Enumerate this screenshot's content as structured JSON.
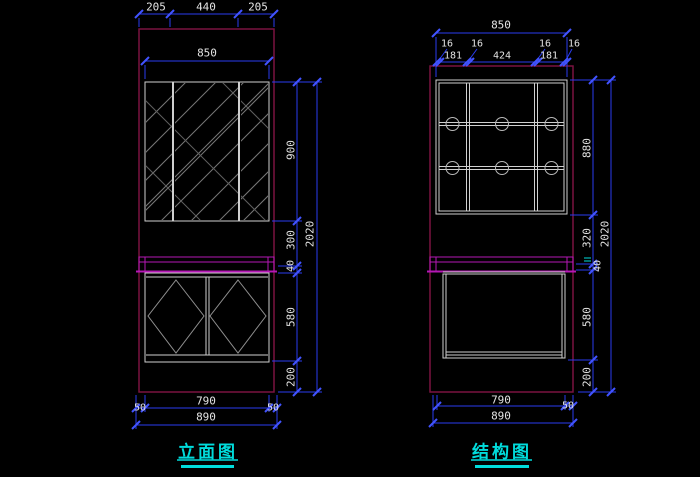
{
  "app": {
    "type": "cad-drawing-viewport",
    "background": "#000000"
  },
  "colors": {
    "dimension_line": "#2a3cf0",
    "dimension_tick": "#4153ff",
    "dimension_text": "#e3e3e3",
    "wall_outline": "#7a1240",
    "countertop": "#b517b5",
    "cabinet_lines": "#cfcfcf",
    "hatch": "#787878",
    "title_cyan": "#00dcdc"
  },
  "left_view": {
    "title": "立面图",
    "dims": {
      "top_segments": [
        "205",
        "440",
        "205"
      ],
      "width": "850",
      "mirror_height": "900",
      "gap_height": "300",
      "counter_thickness": "40",
      "total_height": "2020",
      "cabinet_height": "580",
      "plinth_height": "200",
      "bottom_width": "790",
      "side_overhangs": [
        "50",
        "50"
      ],
      "floor_width": "890"
    }
  },
  "right_view": {
    "title": "结构图",
    "dims": {
      "width": "850",
      "panel_thicknesses": [
        "16",
        "16",
        "16",
        "16"
      ],
      "compartments": [
        "181",
        "424",
        "181"
      ],
      "body_height": "880",
      "gap_height": "320",
      "counter_thickness": "40",
      "total_height": "2020",
      "cabinet_height": "580",
      "plinth_height": "200",
      "bottom_width": "790",
      "side_overhang": "50",
      "floor_width": "890"
    }
  }
}
